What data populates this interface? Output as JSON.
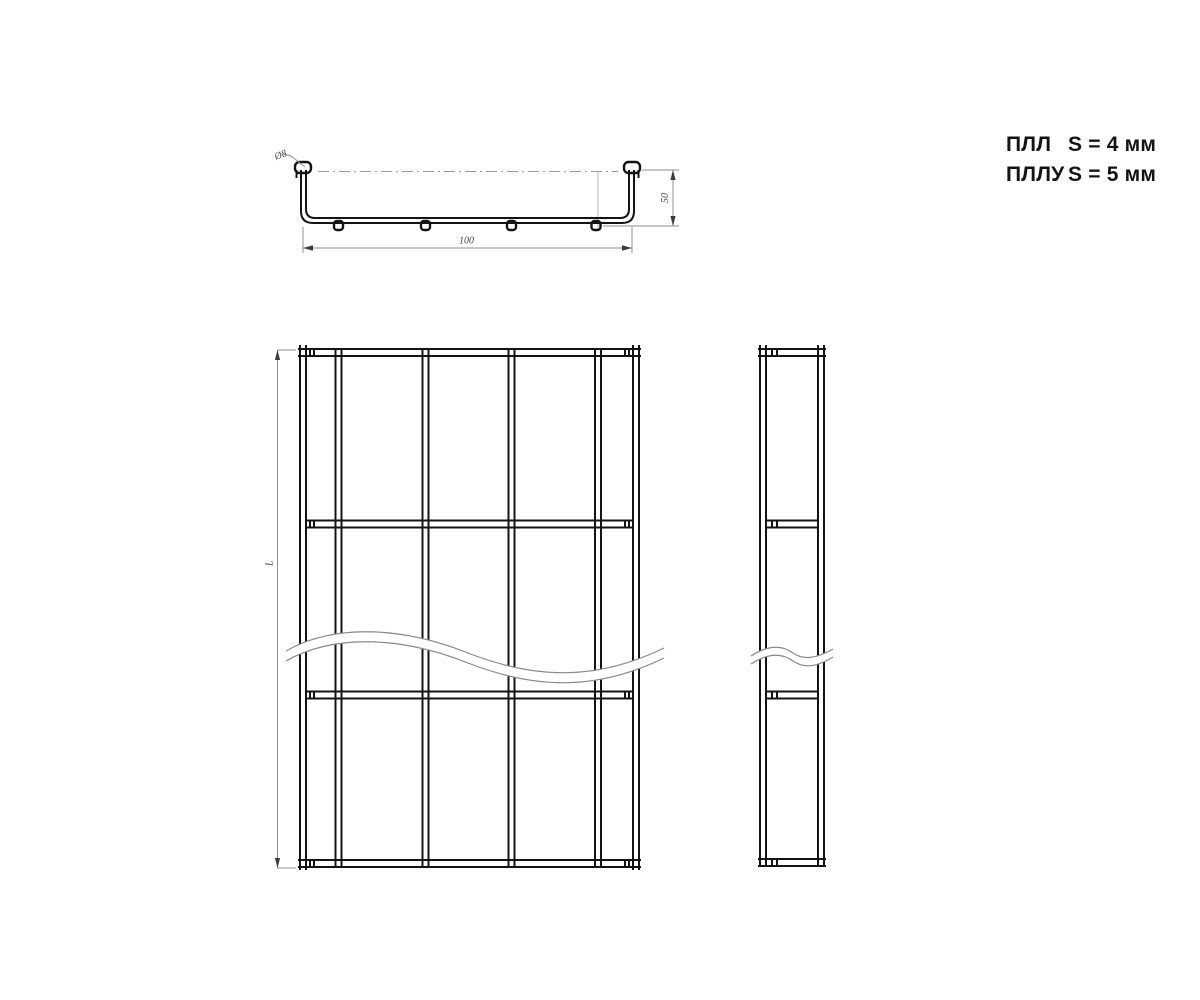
{
  "legend": {
    "rows": [
      {
        "model": "ПЛЛ",
        "spec": "S = 4 мм"
      },
      {
        "model": "ПЛЛУ",
        "spec": "S = 5 мм"
      }
    ]
  },
  "drawing": {
    "section_view": {
      "wire_label": "Ø8",
      "width_dim": "100",
      "height_dim": "50"
    },
    "front_view": {
      "length_dim": "L"
    },
    "colors": {
      "line": "#141414",
      "dimension_line": "#8f8f8f",
      "dimension_text": "#4a4a4a",
      "background": "#ffffff"
    }
  }
}
